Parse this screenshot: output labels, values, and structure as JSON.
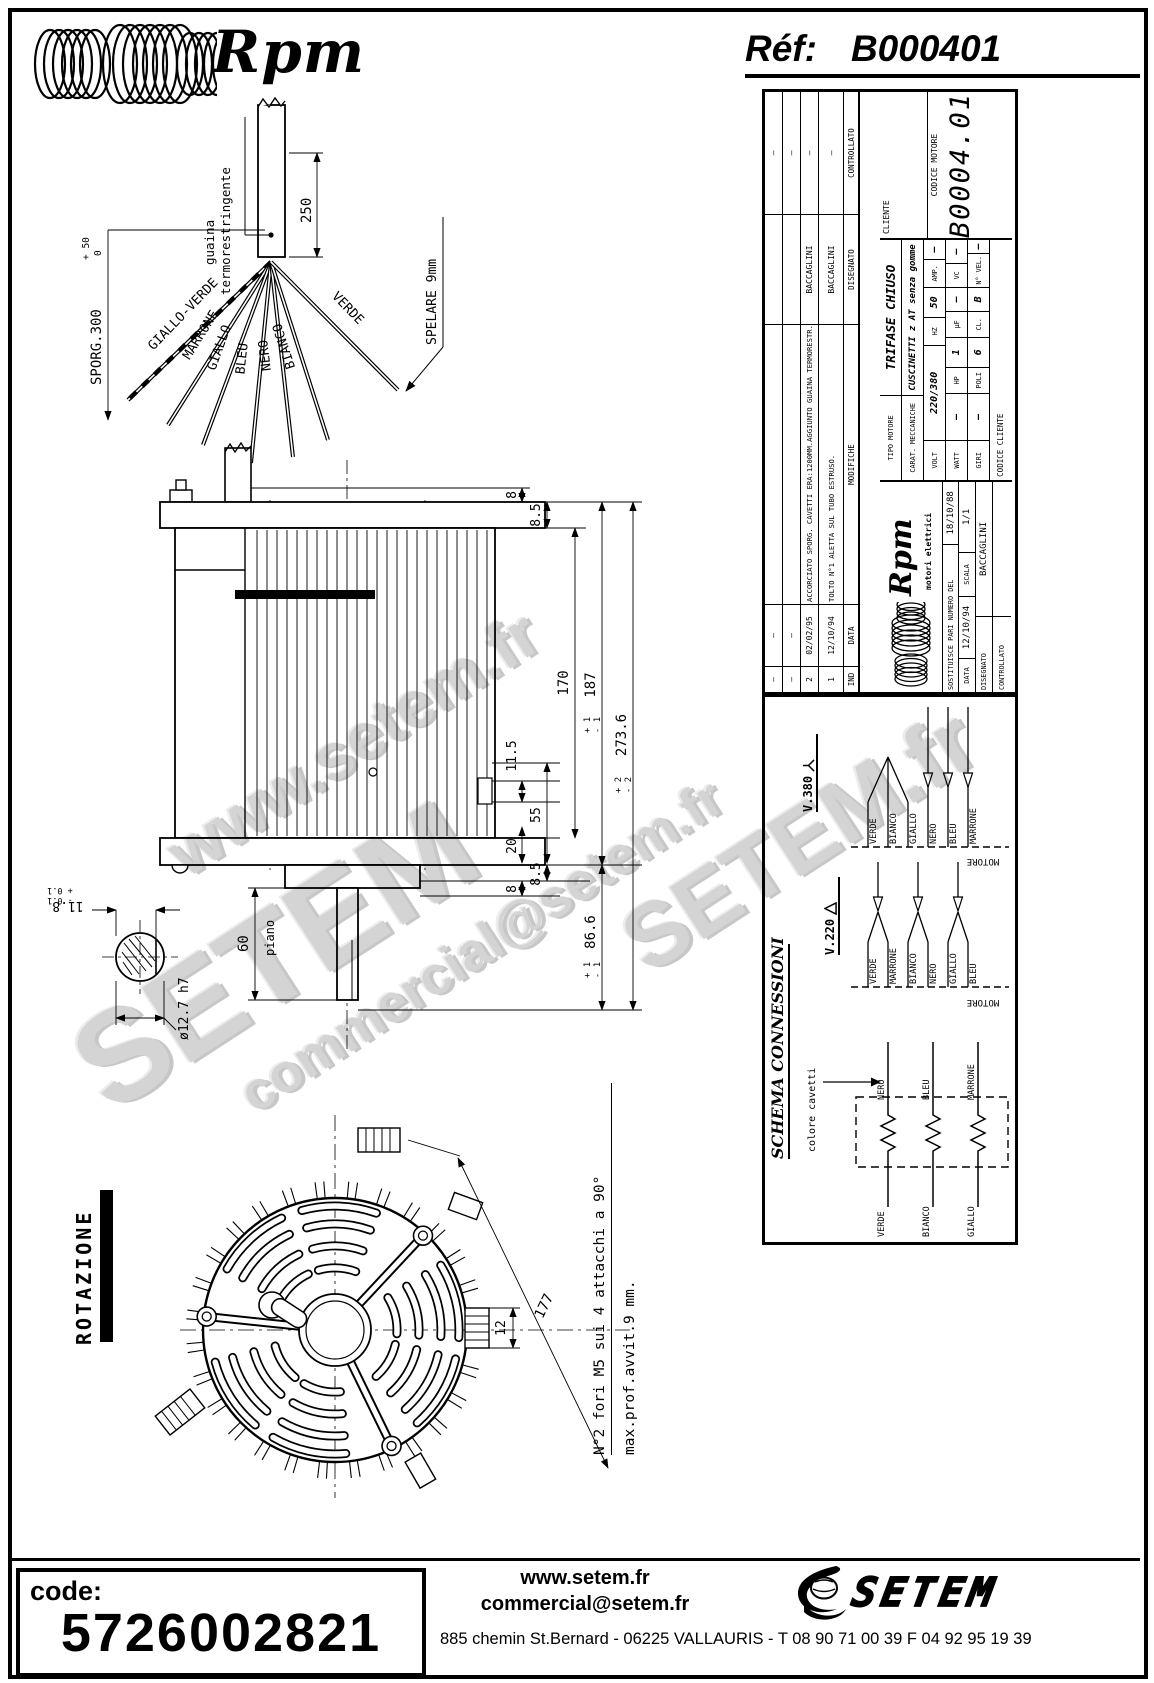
{
  "colors": {
    "ink": "#000000",
    "paper": "#ffffff",
    "watermark": "#c9c9c9"
  },
  "header": {
    "brand": "Rpm",
    "ref_label": "Réf:",
    "ref_value": "B000401"
  },
  "watermarks": [
    "www.setem.fr",
    "SETEM",
    "commercial@setem.fr",
    "SETEM.fr"
  ],
  "wire_fan": {
    "sleeve_line1": "guaina",
    "sleeve_line2": "termorestringente",
    "dim_250": "250",
    "sporg": "SPORG.300",
    "sporg_tol_plus": "+ 50",
    "sporg_tol_minus": "0",
    "spelare": "SPELARE 9mm",
    "wires": [
      "GIALLO-VERDE",
      "MARRONE",
      "GIALLO",
      "BLEU",
      "NERO",
      "BIANCO",
      "VERDE"
    ]
  },
  "side_view": {
    "dim_8_top": "8",
    "dim_85_top": "8.5",
    "dim_170": "170",
    "dim_187": "187",
    "dim_187_tp": "+ 1",
    "dim_187_tm": "- 1",
    "dim_2736": "273.6",
    "dim_2736_tp": "+ 2",
    "dim_2736_tm": "- 2",
    "dim_115": "11.5",
    "dim_55": "55",
    "dim_20": "20",
    "dim_85_bot": "8.5",
    "dim_8_bot": "8",
    "dim_866": "86.6",
    "dim_866_tp": "+ 1",
    "dim_866_tm": "- 1",
    "dim_60": "60",
    "piano_label": "piano",
    "dim_shaft": "ø12.7 h7",
    "dim_118": "11.8",
    "dim_118_tp": "+ 0.1",
    "dim_118_tm": "- 0.1"
  },
  "fan_view": {
    "rotazione": "ROTAZIONE",
    "dim_12": "12",
    "dim_177": "177",
    "note1": "N°2 fori M5 sui 4 attacchi a 90°",
    "note2": "max.prof.avvit.9 mm."
  },
  "titleblock": {
    "revisions": {
      "col_ind": "IND",
      "col_data": "DATA",
      "col_mod": "MODIFICHE",
      "col_dis": "DISEGNATO",
      "col_con": "CONTROLLATO",
      "rows": [
        {
          "ind": "–",
          "data": "–",
          "mod": "",
          "dis": "",
          "con": "–"
        },
        {
          "ind": "–",
          "data": "–",
          "mod": "",
          "dis": "",
          "con": "–"
        },
        {
          "ind": "2",
          "data": "02/02/95",
          "mod": "ACCORCIATO SPORG. CAVETTI ERA:1200MM.AGGIUNTO GUAINA TERMORESTR.",
          "dis": "BACCAGLINI",
          "con": "–"
        },
        {
          "ind": "1",
          "data": "12/10/94",
          "mod": "TOLTO N°1 ALETTA SUL TUBO ESTRUSO.",
          "dis": "BACCAGLINI",
          "con": "–"
        }
      ]
    },
    "logo_brand": "Rpm",
    "logo_sub": "motori elettrici",
    "sostituisce_label": "SOSTITUISCE PARI NUMERO DEL",
    "sostituisce_value": "18/10/88",
    "data_label": "DATA",
    "data_value": "12/10/94",
    "scala_label": "SCALA",
    "scala_value": "1/1",
    "disegnato_label": "DISEGNATO",
    "disegnato_value": "BACCAGLINI",
    "controllato_label": "CONTROLLATO",
    "controllato_value": "",
    "tipo_label": "TIPO MOTORE",
    "tipo_value": "TRIFASE CHIUSO",
    "carat_label": "CARAT. MECCANICHE",
    "carat_value": "CUSCINETTI z AT senza gomme",
    "volt_label": "VOLT",
    "volt_value": "220/380",
    "hz_label": "HZ",
    "hz_value": "50",
    "amp_label": "AMP.",
    "amp_value": "–",
    "watt_label": "WATT",
    "watt_value": "–",
    "hp_label": "HP",
    "hp_value": "1",
    "uf_label": "µF",
    "uf_value": "–",
    "vc_label": "VC",
    "vc_value": "–",
    "giri_label": "GIRI",
    "giri_value": "–",
    "poli_label": "POLI",
    "poli_value": "6",
    "cl_label": "CL.",
    "cl_value": "B",
    "nvel_label": "N° VEL.",
    "nvel_value": "–",
    "cliente_label": "CLIENTE",
    "codice_motore_label": "CODICE MOTORE",
    "codice_motore_value": "B0004.01",
    "codice_cliente_label": "CODICE CLIENTE"
  },
  "schema": {
    "title": "SCHEMA CONNESSIONI",
    "colore": "colore cavetti",
    "motore": "MOTORE",
    "v380": "V.380",
    "v220": "V.220",
    "v380_wires": [
      "VERDE",
      "BIANCO",
      "GIALLO",
      "NERO",
      "BLEU",
      "MARRONE"
    ],
    "v220_wires": [
      "VERDE",
      "MARRONE",
      "BIANCO",
      "NERO",
      "GIALLO",
      "BLEU"
    ],
    "winding_top": [
      "NERO",
      "BLEU",
      "MARRONE"
    ],
    "winding_bottom": [
      "VERDE",
      "BIANCO",
      "GIALLO"
    ]
  },
  "footer": {
    "code_label": "code:",
    "code_value": "5726002821",
    "site": "www.setem.fr",
    "email": "commercial@setem.fr",
    "brand": "SETEM",
    "address": "885 chemin St.Bernard  -  06225 VALLAURIS  -  T 08 90 71 00 39   F 04 92 95 19 39"
  }
}
